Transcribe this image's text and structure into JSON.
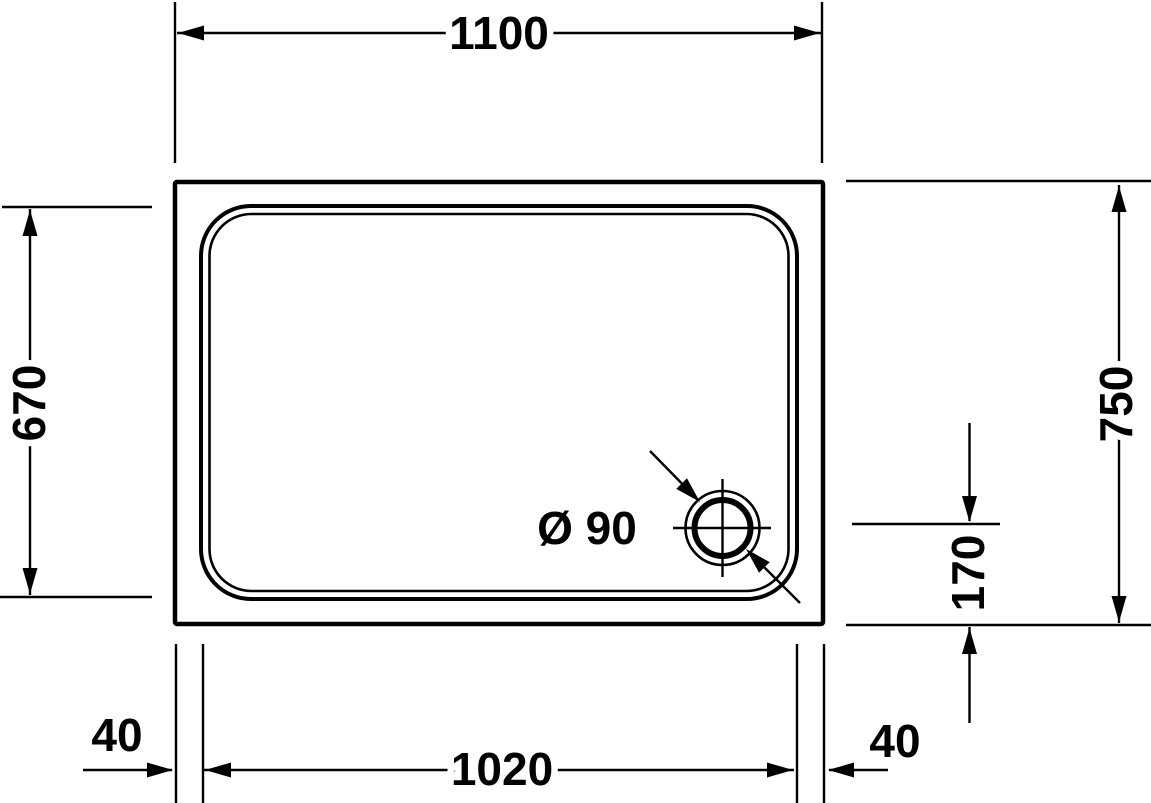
{
  "drawing": {
    "colors": {
      "line": "#000000",
      "tray_fill": "#ffffff",
      "background": "#ffffff"
    },
    "dimensions": {
      "top_width": {
        "label": "1100"
      },
      "left_inner_height": {
        "label": "670"
      },
      "right_overall_height": {
        "label": "750"
      },
      "drain_center_to_bottom": {
        "label": "170"
      },
      "bottom_left_rim": {
        "label": "40"
      },
      "bottom_inner_width": {
        "label": "1020"
      },
      "bottom_right_rim": {
        "label": "40"
      },
      "drain_diameter": {
        "label": "Ø 90"
      }
    }
  }
}
